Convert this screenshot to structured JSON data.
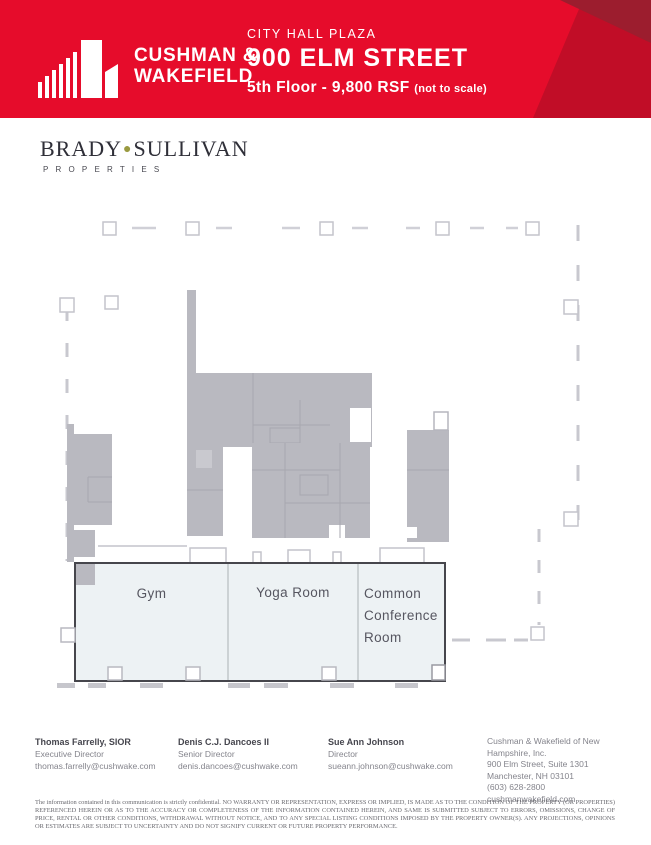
{
  "header": {
    "brand_line1": "CUSHMAN &",
    "brand_line2": "WAKEFIELD",
    "property": "CITY HALL PLAZA",
    "address": "900 ELM STREET",
    "floor_info": "5th Floor - 9,800 RSF",
    "scale_note": "(not to scale)",
    "colors": {
      "red": "#e60c2b",
      "red_dark": "#9c1d2e",
      "red_mid": "#c10d27"
    }
  },
  "landlord": {
    "name_left": "BRADY",
    "name_right": "SULLIVAN",
    "subtitle": "PROPERTIES",
    "dot": "●"
  },
  "plan": {
    "rooms": [
      {
        "label": "Gym"
      },
      {
        "label": "Yoga Room"
      },
      {
        "lines": [
          "Common",
          "Conference",
          "Room"
        ]
      }
    ],
    "colors": {
      "fill_gray": "#b9b9c0",
      "line_gray": "#c8c8cf",
      "suite_fill": "#edf2f4",
      "suite_border": "#46464c"
    }
  },
  "contacts": [
    {
      "name": "Thomas Farrelly, SIOR",
      "title": "Executive Director",
      "email": "thomas.farrelly@cushwake.com"
    },
    {
      "name": "Denis C.J. Dancoes II",
      "title": "Senior Director",
      "email": "denis.dancoes@cushwake.com"
    },
    {
      "name": "Sue Ann Johnson",
      "title": "Director",
      "email": "sueann.johnson@cushwake.com"
    }
  ],
  "company": {
    "lines": [
      "Cushman & Wakefield of New",
      "Hampshire, Inc.",
      "900 Elm Street, Suite 1301",
      "Manchester, NH 03101",
      "(603) 628-2800",
      "cushmanwakefield.com"
    ]
  },
  "disclaimer": "The information contained in this communication is strictly confidential. NO WARRANTY OR REPRESENTATION, EXPRESS OR IMPLIED, IS MADE AS TO THE CONDITION OF THE PROPERTY (OR PROPERTIES) REFERENCED HEREIN OR AS TO THE ACCURACY OR COMPLETENESS OF THE INFORMATION CONTAINED HEREIN, AND SAME IS SUBMITTED SUBJECT TO ERRORS, OMISSIONS, CHANGE OF PRICE, RENTAL OR OTHER CONDITIONS, WITHDRAWAL WITHOUT NOTICE, AND TO ANY SPECIAL LISTING CONDITIONS IMPOSED BY THE PROPERTY OWNER(S). ANY PROJECTIONS, OPINIONS OR ESTIMATES ARE SUBJECT TO UNCERTAINTY AND DO NOT SIGNIFY CURRENT OR FUTURE PROPERTY PERFORMANCE."
}
